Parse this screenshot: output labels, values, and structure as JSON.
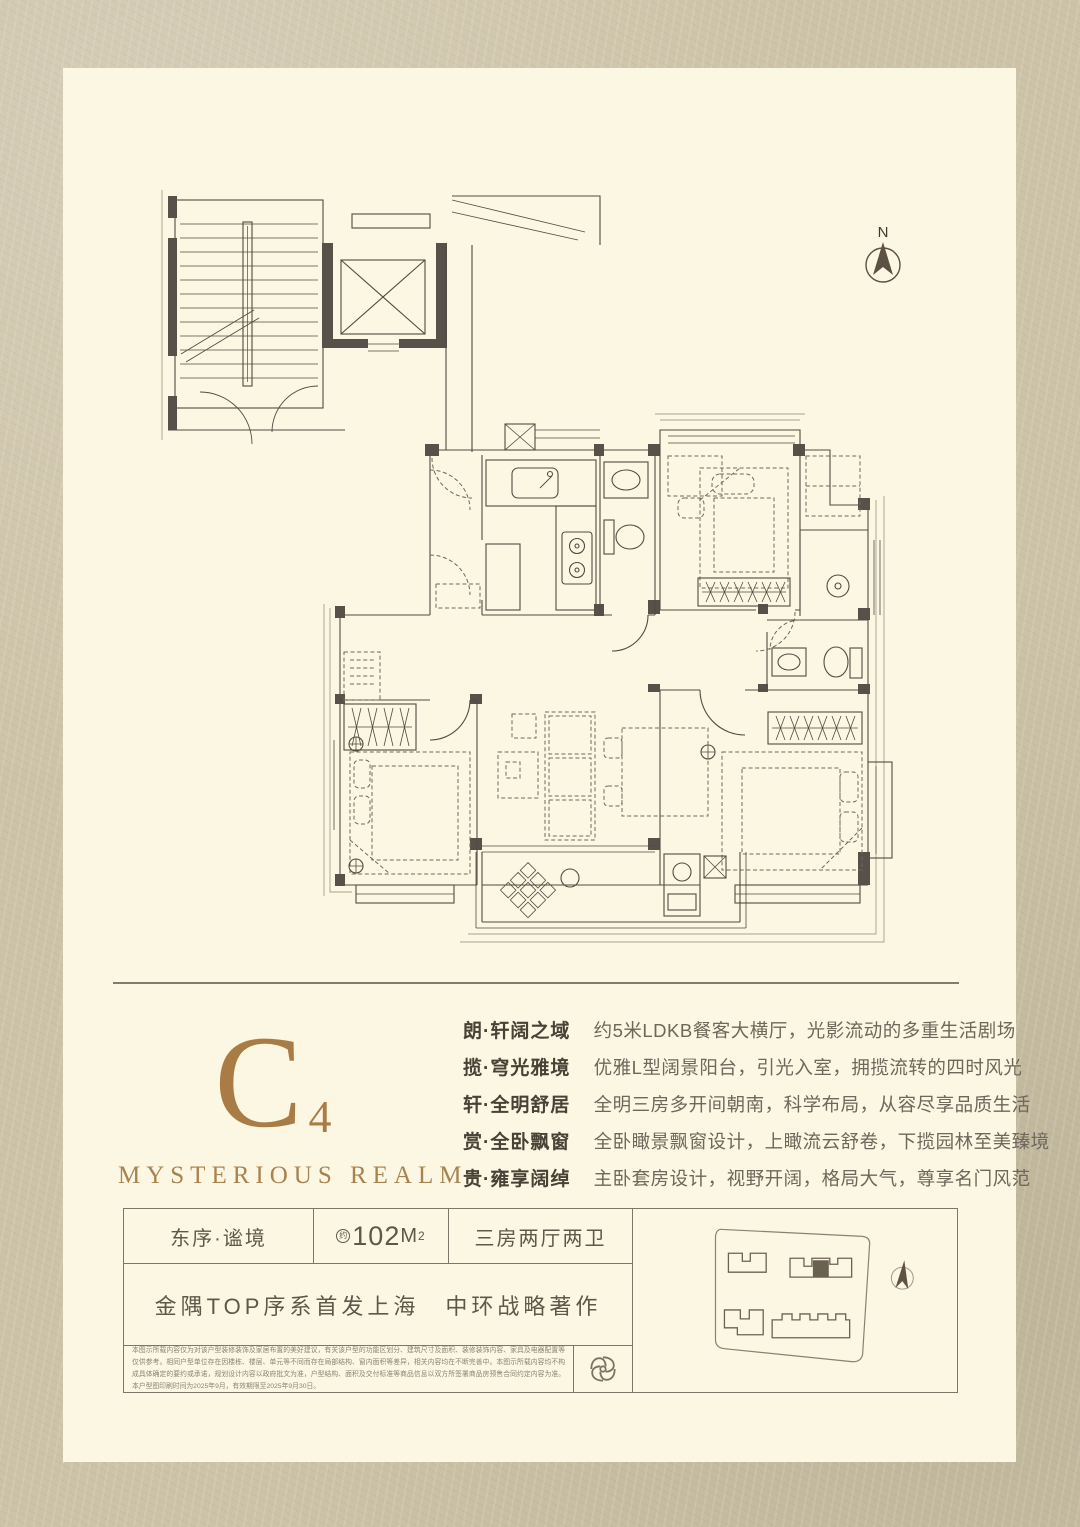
{
  "compass": {
    "north_label": "N"
  },
  "headline": {
    "unit_letter": "C",
    "unit_number": "4",
    "subtitle_en": "MYSTERIOUS REALM",
    "accent_color": "#aa7c45"
  },
  "features": [
    {
      "label": "朗·轩阔之域",
      "desc": "约5米LDKB餐客大横厅，光影流动的多重生活剧场"
    },
    {
      "label": "揽·穹光雅境",
      "desc": "优雅L型阔景阳台，引光入室，拥揽流转的四时风光"
    },
    {
      "label": "轩·全明舒居",
      "desc": "全明三房多开间朝南，科学布局，从容尽享品质生活"
    },
    {
      "label": "赏·全卧飘窗",
      "desc": "全卧瞰景飘窗设计，上瞰流云舒卷，下揽园林至美臻境"
    },
    {
      "label": "贵·雍享阔绰",
      "desc": "主卧套房设计，视野开阔，格局大气，尊享名门风范"
    }
  ],
  "info_table": {
    "name": "东序·谧境",
    "area_prefix": "约",
    "area_value": "102",
    "area_unit": "M",
    "area_sup": "2",
    "layout": "三房两厅两卫",
    "slogan": "金隅TOP序系首发上海　中环战略著作",
    "disclaimer": "本图示所载内容仅为对该户型装修装饰及家居布置的美好建议，有关该户型的功能区划分、建筑尺寸及面积、装修装饰内容、家具及电器配置等仅供参考。相同户型单位存在因楼栋、楼层、单元等不同而存在局部结构、窗内面积等差异，相关内容均在不断完善中。本图示所载内容均不构成具体确定的要约或承诺，规划设计内容以政府批文为准，户型结构、面积及交付标准等商品信息以双方所签署商品房预售合同约定内容为准。本户型图印刷时间为2025年9月，有效期限至2025年9月30日。"
  },
  "icons": {
    "compass": "north-arrow in circle",
    "site_compass": "small tilted north needle",
    "logo": "interlocking knot emblem"
  },
  "colors": {
    "outer_background": "#cdc3a8",
    "card_background": "#fcf7e2",
    "plan_line": "#514b43",
    "wall_fill": "#57514a",
    "accent_gold": "#aa7c45",
    "table_border": "#7e7668"
  }
}
